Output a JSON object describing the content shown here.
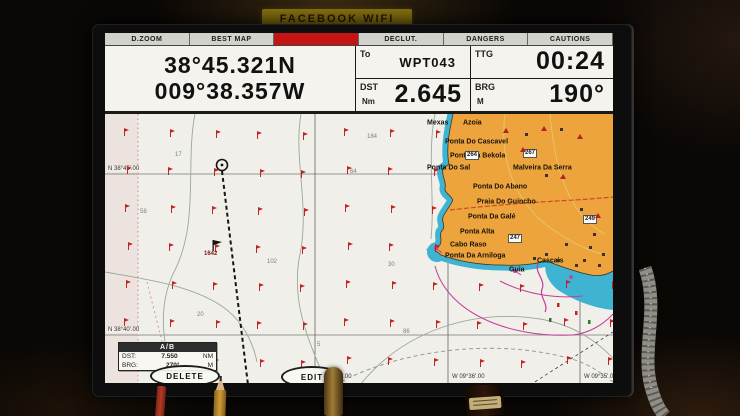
{
  "sticker": {
    "label": "FACEBOOK WIFI"
  },
  "topbar": {
    "items": [
      {
        "label": "D.ZOOM"
      },
      {
        "label": "BEST MAP"
      },
      {
        "label": "",
        "selected": true,
        "color": "#c41414"
      },
      {
        "label": "DECLUT."
      },
      {
        "label": "DANGERS"
      },
      {
        "label": "CAUTIONS"
      }
    ]
  },
  "nav": {
    "position": {
      "lat": "38°45.321N",
      "lon": "009°38.357W"
    },
    "to": {
      "label": "To",
      "value": "WPT043"
    },
    "ttg": {
      "label": "TTG",
      "value": "00:24"
    },
    "dst": {
      "label": "DST",
      "unit": "Nm",
      "value": "2.645"
    },
    "brg": {
      "label": "BRG",
      "unit": "M",
      "value": "190°"
    }
  },
  "chart": {
    "waypoint_label": "1642",
    "lat_labels": [
      {
        "label": "N 38°45'.00",
        "x": 2,
        "y": 52
      },
      {
        "label": "N 38°40'.00",
        "x": 2,
        "y": 213
      }
    ],
    "lon_labels": [
      {
        "label": "W 09°37'.00",
        "x": 213,
        "y": 260
      },
      {
        "label": "W 09°36'.00",
        "x": 346,
        "y": 260
      },
      {
        "label": "W 09°35'.00",
        "x": 478,
        "y": 260
      }
    ],
    "place_names": [
      {
        "label": "Mexas",
        "x": 322,
        "y": 9
      },
      {
        "label": "Azoia",
        "x": 358,
        "y": 9
      },
      {
        "label": "Ponta Do Cascavel",
        "x": 340,
        "y": 28
      },
      {
        "label": "Ponta Da Bekola",
        "x": 345,
        "y": 42
      },
      {
        "label": "Ponta Do Sal",
        "x": 322,
        "y": 54
      },
      {
        "label": "Malveira Da Serra",
        "x": 408,
        "y": 54
      },
      {
        "label": "Ponta Do Abano",
        "x": 368,
        "y": 73
      },
      {
        "label": "Praia Do Guincho",
        "x": 372,
        "y": 88
      },
      {
        "label": "Ponta Da Galé",
        "x": 363,
        "y": 103
      },
      {
        "label": "Ponta Alta",
        "x": 355,
        "y": 118
      },
      {
        "label": "Cabo Raso",
        "x": 345,
        "y": 131
      },
      {
        "label": "Ponta Da Arniloga",
        "x": 340,
        "y": 142
      },
      {
        "label": "Cascais",
        "x": 432,
        "y": 147
      },
      {
        "label": "Guia",
        "x": 404,
        "y": 156
      }
    ],
    "road_badges": [
      {
        "label": "264",
        "x": 360,
        "y": 37
      },
      {
        "label": "267",
        "x": 418,
        "y": 35
      },
      {
        "label": "247",
        "x": 403,
        "y": 120
      },
      {
        "label": "249",
        "x": 478,
        "y": 101
      }
    ],
    "soundings": [
      {
        "label": "17",
        "x": 70,
        "y": 38
      },
      {
        "label": "58",
        "x": 35,
        "y": 95
      },
      {
        "label": "184",
        "x": 262,
        "y": 20
      },
      {
        "label": "64",
        "x": 245,
        "y": 55
      },
      {
        "label": "102",
        "x": 162,
        "y": 145
      },
      {
        "label": "30",
        "x": 283,
        "y": 148
      },
      {
        "label": "20",
        "x": 92,
        "y": 198
      },
      {
        "label": "5",
        "x": 212,
        "y": 228
      },
      {
        "label": "124",
        "x": 55,
        "y": 248
      },
      {
        "label": "86",
        "x": 298,
        "y": 215
      }
    ],
    "peaks": [
      {
        "x": 398,
        "y": 14
      },
      {
        "x": 436,
        "y": 12
      },
      {
        "x": 415,
        "y": 33
      },
      {
        "x": 472,
        "y": 20
      },
      {
        "x": 455,
        "y": 60
      },
      {
        "x": 490,
        "y": 99
      }
    ],
    "buildings": [
      {
        "x": 428,
        "y": 143
      },
      {
        "x": 440,
        "y": 139
      },
      {
        "x": 452,
        "y": 145
      },
      {
        "x": 470,
        "y": 150
      },
      {
        "x": 478,
        "y": 145
      },
      {
        "x": 460,
        "y": 129
      },
      {
        "x": 488,
        "y": 119
      },
      {
        "x": 475,
        "y": 94
      },
      {
        "x": 440,
        "y": 60
      },
      {
        "x": 420,
        "y": 19
      },
      {
        "x": 455,
        "y": 14
      },
      {
        "x": 497,
        "y": 139
      },
      {
        "x": 493,
        "y": 150
      },
      {
        "x": 484,
        "y": 132
      }
    ],
    "symbol_grid": {
      "cols": [
        18,
        62,
        106,
        150,
        194,
        238,
        282,
        326,
        370,
        414,
        458,
        502
      ],
      "rows": [
        16,
        54,
        92,
        130,
        168,
        206,
        244
      ]
    },
    "info_box": {
      "title": "A/B",
      "rows": [
        {
          "label": "DST:",
          "value": "7.550",
          "unit": "NM"
        },
        {
          "label": "BRG:",
          "value": "270°",
          "unit": "M"
        }
      ]
    },
    "buttons": [
      {
        "label": "DELETE"
      },
      {
        "label": "EDIT"
      }
    ]
  },
  "colors": {
    "land": "#eda43c",
    "shallow_water": "#3fb4d2",
    "softkey_selected": "#c41414",
    "chart_symbol_red": "#c02424",
    "magenta": "#c43c9c"
  }
}
